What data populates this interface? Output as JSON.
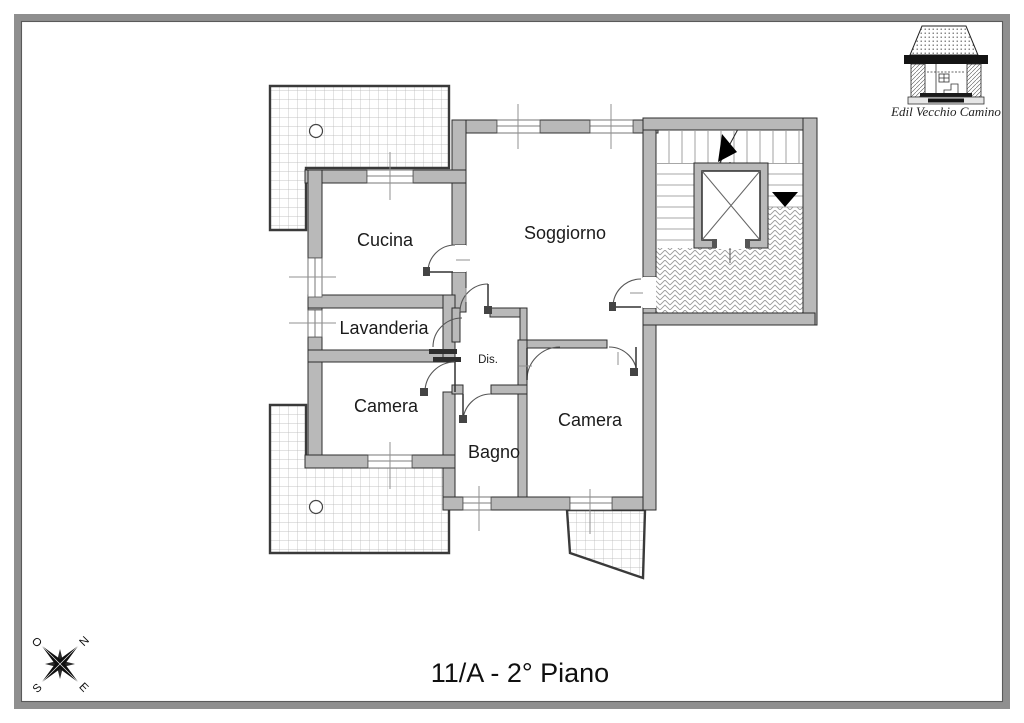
{
  "page": {
    "title": "11/A - 2° Piano"
  },
  "logo": {
    "company": "Edil Vecchio Camino",
    "icon": "fireplace-logo-icon"
  },
  "compass": {
    "icon": "compass-rose-icon",
    "north": "N",
    "west": "O",
    "east": "E",
    "south": "S"
  },
  "plan": {
    "rooms": {
      "cucina": {
        "label": "Cucina"
      },
      "soggiorno": {
        "label": "Soggiorno"
      },
      "lavanderia": {
        "label": "Lavanderia"
      },
      "camera_1": {
        "label": "Camera"
      },
      "camera_2": {
        "label": "Camera"
      },
      "bagno": {
        "label": "Bagno"
      },
      "disimpegno": {
        "label": "Dis."
      }
    },
    "features": {
      "stairs": "stairs-icon",
      "elevator": "elevator-icon",
      "stair_up_arrow": "up-arrow-icon",
      "stair_down_marker": "down-triangle-icon",
      "terrace_hatch": "grid-hatch",
      "landing_hatch": "herringbone-hatch"
    },
    "colors": {
      "wall_fill": "#b9b9b9",
      "frame": "#8f8f8f",
      "ink": "#2d2d2d"
    }
  }
}
